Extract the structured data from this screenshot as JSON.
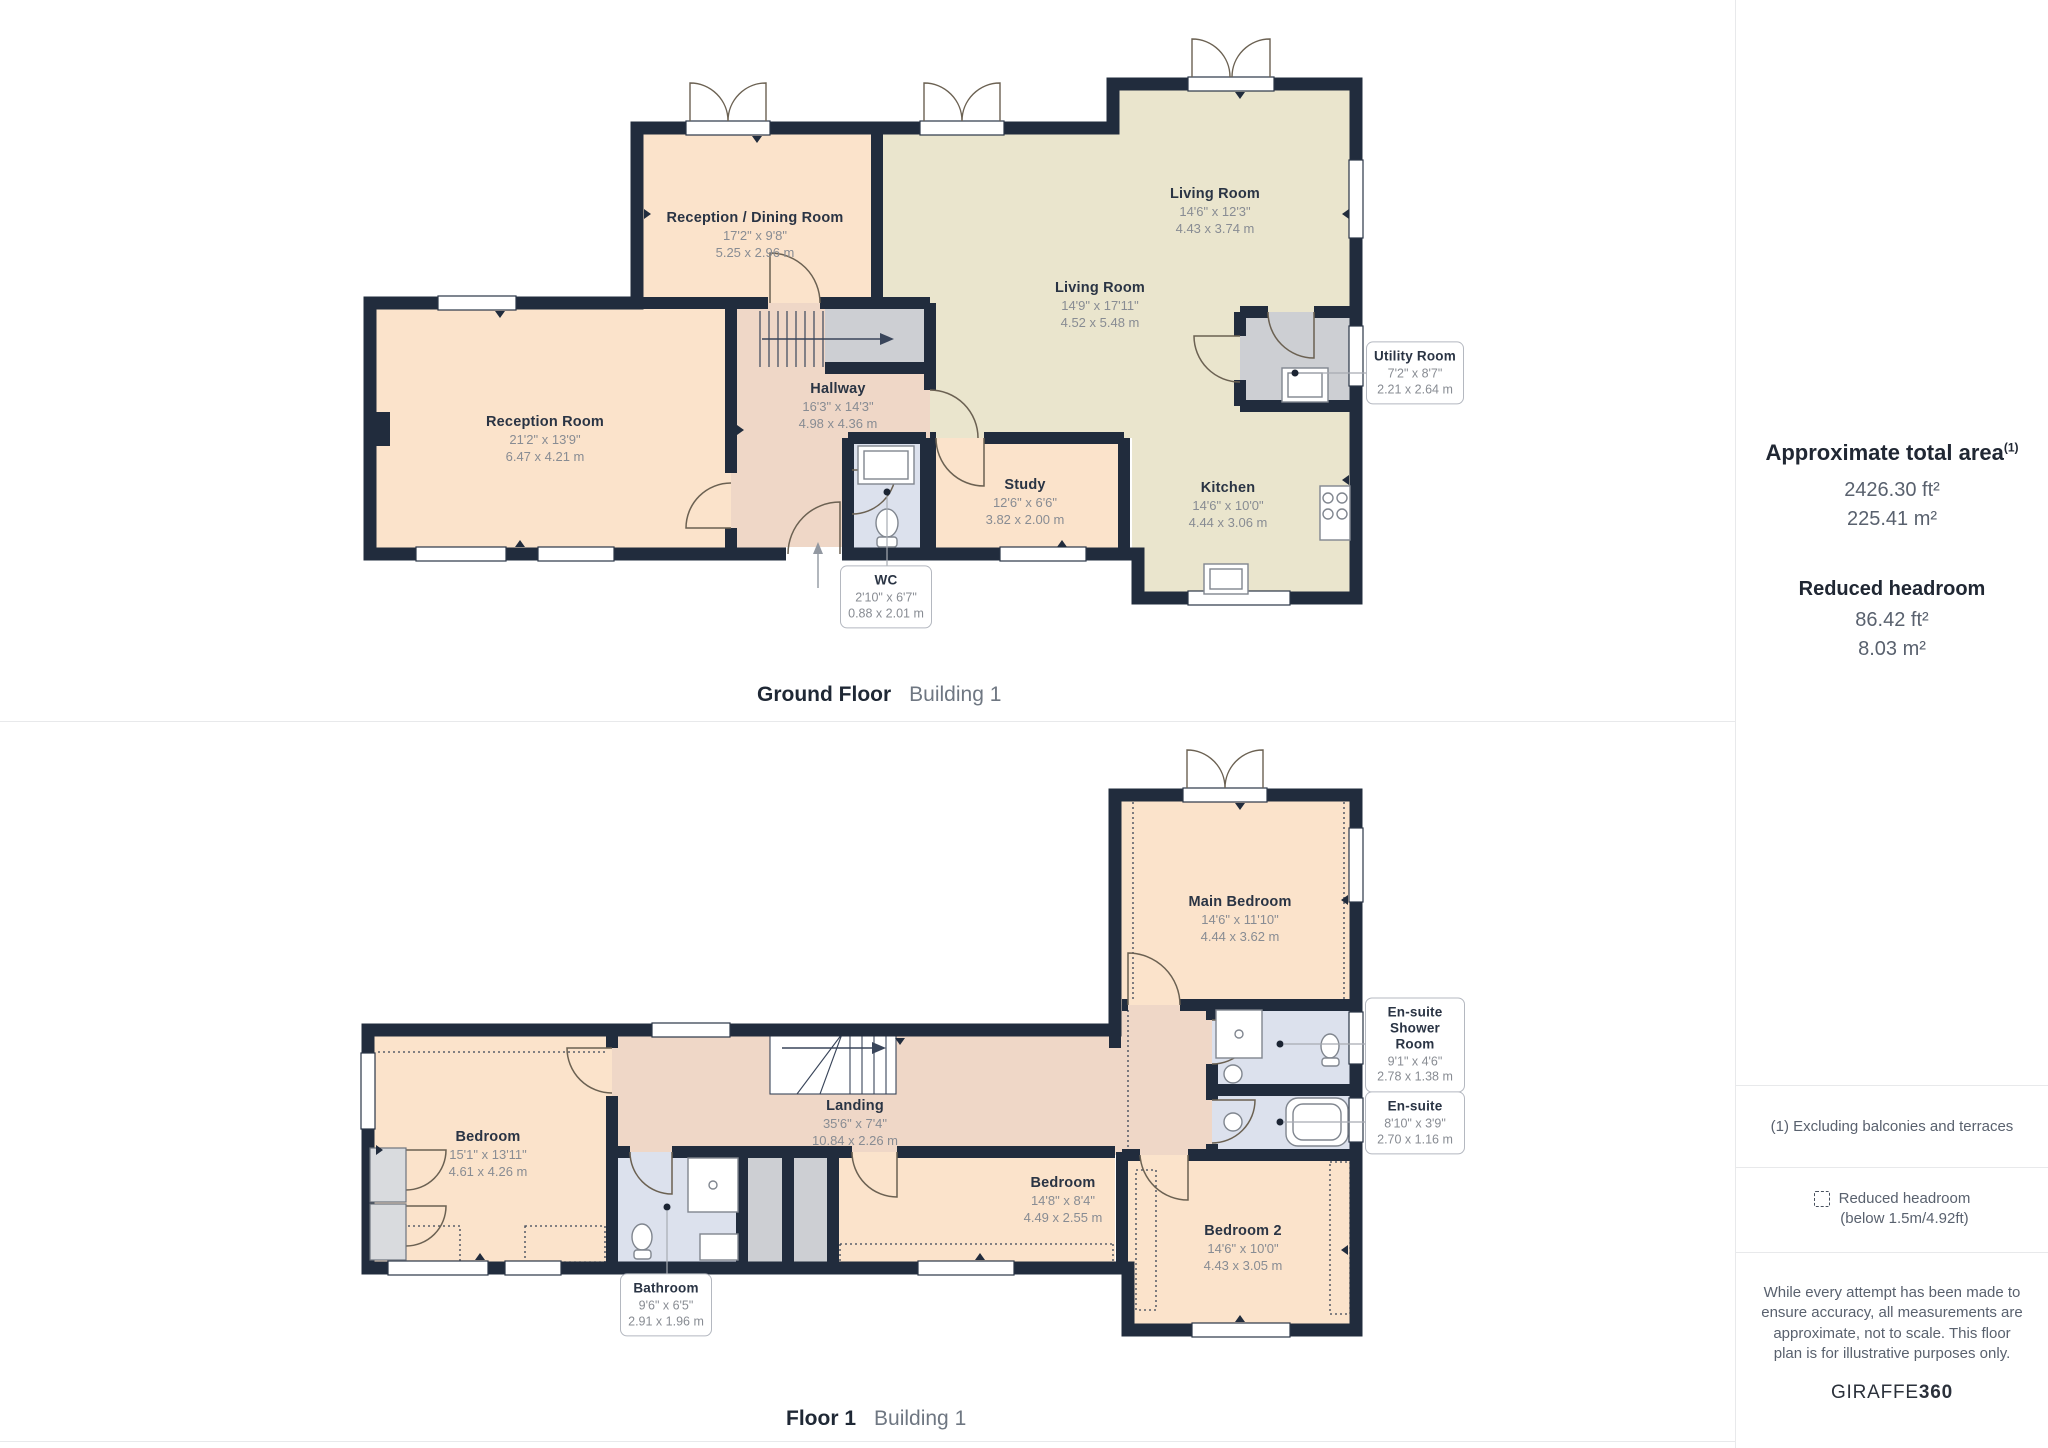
{
  "ground_floor": {
    "caption": {
      "title": "Ground Floor",
      "subtitle": "Building 1"
    },
    "rooms": [
      {
        "name": "Reception / Dining Room",
        "dims_ft": "17'2\" x 9'8\"",
        "dims_m": "5.25 x 2.96 m"
      },
      {
        "name": "Living Room",
        "dims_ft": "14'6\" x 12'3\"",
        "dims_m": "4.43 x 3.74 m"
      },
      {
        "name": "Living Room",
        "dims_ft": "14'9\" x 17'11\"",
        "dims_m": "4.52 x 5.48 m"
      },
      {
        "name": "Reception Room",
        "dims_ft": "21'2\" x 13'9\"",
        "dims_m": "6.47 x 4.21 m"
      },
      {
        "name": "Hallway",
        "dims_ft": "16'3\" x 14'3\"",
        "dims_m": "4.98 x 4.36 m"
      },
      {
        "name": "Study",
        "dims_ft": "12'6\" x 6'6\"",
        "dims_m": "3.82 x 2.00 m"
      },
      {
        "name": "Kitchen",
        "dims_ft": "14'6\" x 10'0\"",
        "dims_m": "4.44 x 3.06 m"
      }
    ],
    "callouts": [
      {
        "name": "Utility Room",
        "dims_ft": "7'2\" x 8'7\"",
        "dims_m": "2.21 x 2.64 m"
      },
      {
        "name": "WC",
        "dims_ft": "2'10\" x 6'7\"",
        "dims_m": "0.88 x 2.01 m"
      }
    ]
  },
  "floor_1": {
    "caption": {
      "title": "Floor 1",
      "subtitle": "Building 1"
    },
    "rooms": [
      {
        "name": "Main Bedroom",
        "dims_ft": "14'6\" x 11'10\"",
        "dims_m": "4.44 x 3.62 m"
      },
      {
        "name": "Bedroom",
        "dims_ft": "15'1\" x 13'11\"",
        "dims_m": "4.61 x 4.26 m"
      },
      {
        "name": "Landing",
        "dims_ft": "35'6\" x 7'4\"",
        "dims_m": "10.84 x 2.26 m"
      },
      {
        "name": "Bedroom",
        "dims_ft": "14'8\" x 8'4\"",
        "dims_m": "4.49 x 2.55 m"
      },
      {
        "name": "Bedroom 2",
        "dims_ft": "14'6\" x 10'0\"",
        "dims_m": "4.43 x 3.05 m"
      }
    ],
    "callouts": [
      {
        "name": "En-suite Shower Room",
        "dims_ft": "9'1\" x 4'6\"",
        "dims_m": "2.78 x 1.38 m"
      },
      {
        "name": "En-suite",
        "dims_ft": "8'10\" x 3'9\"",
        "dims_m": "2.70 x 1.16 m"
      },
      {
        "name": "Bathroom",
        "dims_ft": "9'6\" x 6'5\"",
        "dims_m": "2.91 x 1.96 m"
      }
    ]
  },
  "sidebar": {
    "total_area_label": "Approximate total area",
    "footnote_marker": "(1)",
    "total_area_ft": "2426.30 ft²",
    "total_area_m": "225.41 m²",
    "reduced_label": "Reduced headroom",
    "reduced_ft": "86.42 ft²",
    "reduced_m": "8.03 m²",
    "footnote": "(1) Excluding balconies and terraces",
    "legend_line1": "Reduced headroom",
    "legend_line2": "(below 1.5m/4.92ft)",
    "disclaimer": "While every attempt has been made to ensure accuracy, all measurements are approximate, not to scale. This floor plan is for illustrative purposes only.",
    "brand_name": "GIRAFFE",
    "brand_suffix": "360"
  },
  "colors": {
    "wall": "#212C3D",
    "room_warm": "#FBE3CB",
    "room_olive": "#EAE5CD",
    "room_hall": "#EFD7C7",
    "room_wet": "#DCE1ED",
    "room_gray": "#CDCFD3",
    "callout_border": "#B4B8C0",
    "divider": "#E8E9EB"
  }
}
